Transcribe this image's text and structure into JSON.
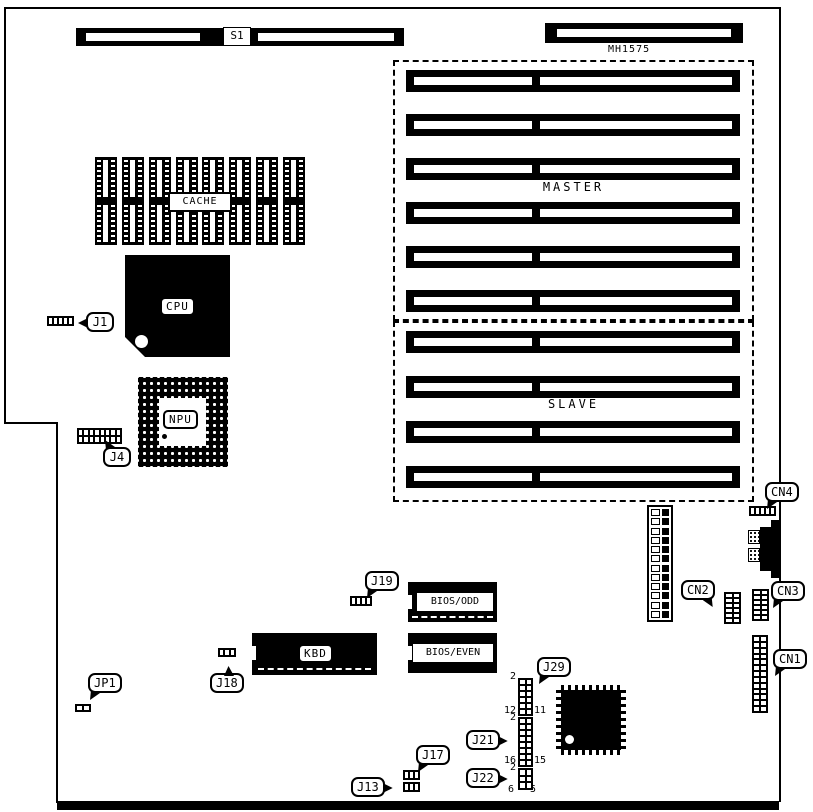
{
  "diagram": {
    "type": "motherboard-component-layout",
    "ink": "#000000",
    "paper": "#ffffff"
  },
  "labels": {
    "s1": "S1",
    "mh1575": "MH1575",
    "cache": "CACHE",
    "cpu": "CPU",
    "npu": "NPU",
    "kbd": "KBD",
    "bios_odd": "BIOS/ODD",
    "bios_even": "BIOS/EVEN"
  },
  "slot_groups": [
    {
      "id": "master",
      "label": "MASTER",
      "slots": 6
    },
    {
      "id": "slave",
      "label": "SLAVE",
      "slots": 4
    }
  ],
  "cache_columns": 8,
  "power_connector": {
    "rows": 12
  },
  "callouts": [
    {
      "id": "j1",
      "label": "J1",
      "x": 86,
      "y": 312,
      "tail": "left"
    },
    {
      "id": "j4",
      "label": "J4",
      "x": 103,
      "y": 447,
      "tail": "top-left"
    },
    {
      "id": "jp1",
      "label": "JP1",
      "x": 88,
      "y": 673,
      "tail": "bottom-left"
    },
    {
      "id": "j18",
      "label": "J18",
      "x": 210,
      "y": 673,
      "tail": "top-center"
    },
    {
      "id": "j19",
      "label": "J19",
      "x": 365,
      "y": 571,
      "tail": "bottom-left"
    },
    {
      "id": "j29",
      "label": "J29",
      "x": 537,
      "y": 657,
      "tail": "bottom-left"
    },
    {
      "id": "j21",
      "label": "J21",
      "x": 466,
      "y": 730,
      "tail": "right"
    },
    {
      "id": "j22",
      "label": "J22",
      "x": 466,
      "y": 768,
      "tail": "right"
    },
    {
      "id": "j17",
      "label": "J17",
      "x": 416,
      "y": 745,
      "tail": "bottom-left"
    },
    {
      "id": "j13",
      "label": "J13",
      "x": 351,
      "y": 777,
      "tail": "right"
    },
    {
      "id": "cn4",
      "label": "CN4",
      "x": 765,
      "y": 482,
      "tail": "bottom-left"
    },
    {
      "id": "cn2",
      "label": "CN2",
      "x": 681,
      "y": 580,
      "tail": "bottom-right"
    },
    {
      "id": "cn3",
      "label": "CN3",
      "x": 771,
      "y": 581,
      "tail": "bottom-left"
    },
    {
      "id": "cn1",
      "label": "CN1",
      "x": 773,
      "y": 649,
      "tail": "bottom-left"
    }
  ],
  "pin_headers": [
    {
      "id": "cn2-header",
      "x": 724,
      "y": 592,
      "w": 17,
      "h": 32,
      "cols": 2,
      "rows": 6
    },
    {
      "id": "cn3-header",
      "x": 752,
      "y": 589,
      "w": 17,
      "h": 32,
      "cols": 2,
      "rows": 6
    },
    {
      "id": "cn1-header",
      "x": 752,
      "y": 635,
      "w": 16,
      "h": 78,
      "cols": 2,
      "rows": 13
    },
    {
      "id": "j29-header",
      "x": 518,
      "y": 678,
      "w": 15,
      "h": 38,
      "cols": 2,
      "rows": 6
    },
    {
      "id": "j21-header",
      "x": 518,
      "y": 717,
      "w": 15,
      "h": 50,
      "cols": 2,
      "rows": 8
    },
    {
      "id": "j22-header",
      "x": 518,
      "y": 768,
      "w": 15,
      "h": 22,
      "cols": 2,
      "rows": 3
    }
  ],
  "jumpers": [
    {
      "id": "j1-jumper",
      "x": 47,
      "y": 316,
      "w": 27,
      "h": 10,
      "cols": 5,
      "rows": 1
    },
    {
      "id": "j4-header",
      "x": 77,
      "y": 428,
      "w": 45,
      "h": 16,
      "cols": 8,
      "rows": 2
    },
    {
      "id": "cn4-jumper",
      "x": 749,
      "y": 506,
      "w": 27,
      "h": 10,
      "cols": 5,
      "rows": 1
    },
    {
      "id": "j19-jumper",
      "x": 350,
      "y": 596,
      "w": 22,
      "h": 10,
      "cols": 4,
      "rows": 1
    },
    {
      "id": "j18-jumper",
      "x": 218,
      "y": 648,
      "w": 18,
      "h": 9,
      "cols": 3,
      "rows": 1
    },
    {
      "id": "jp1-jumper",
      "x": 75,
      "y": 704,
      "w": 16,
      "h": 8,
      "cols": 2,
      "rows": 1
    },
    {
      "id": "j17-jumper",
      "x": 403,
      "y": 770,
      "w": 17,
      "h": 10,
      "cols": 3,
      "rows": 1
    },
    {
      "id": "j13-jumper",
      "x": 403,
      "y": 782,
      "w": 17,
      "h": 10,
      "cols": 3,
      "rows": 1
    }
  ],
  "pin_numbers": [
    {
      "text": "2",
      "x": 504,
      "y": 671,
      "w": 12,
      "align": "right"
    },
    {
      "text": "12",
      "x": 498,
      "y": 705,
      "w": 18,
      "align": "right"
    },
    {
      "text": "11",
      "x": 534,
      "y": 705,
      "w": 18,
      "align": "left"
    },
    {
      "text": "2",
      "x": 504,
      "y": 712,
      "w": 12,
      "align": "right"
    },
    {
      "text": "16",
      "x": 498,
      "y": 755,
      "w": 18,
      "align": "right"
    },
    {
      "text": "15",
      "x": 534,
      "y": 755,
      "w": 18,
      "align": "left"
    },
    {
      "text": "2",
      "x": 504,
      "y": 762,
      "w": 12,
      "align": "right"
    },
    {
      "text": "6",
      "x": 502,
      "y": 784,
      "w": 12,
      "align": "right"
    },
    {
      "text": "5",
      "x": 530,
      "y": 784,
      "w": 12,
      "align": "left"
    }
  ]
}
